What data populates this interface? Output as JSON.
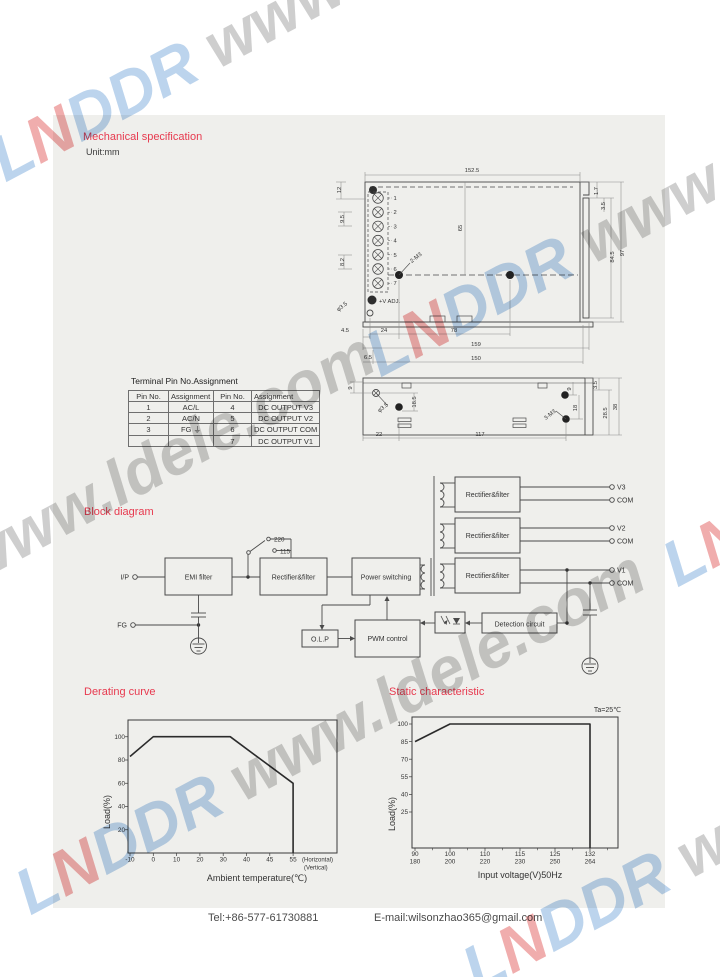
{
  "page": {
    "headings": {
      "mechanical": "Mechanical specification",
      "unit": "Unit:mm",
      "block_diagram": "Block diagram"
    },
    "footer": {
      "tel": "Tel:+86-577-61730881",
      "email": "E-mail:wilsonzhao365@gmail.com"
    }
  },
  "watermark": {
    "segments": [
      {
        "text": "L",
        "color": "#b9d2ec"
      },
      {
        "text": "N",
        "color": "#f0a9a9"
      },
      {
        "text": "DDR",
        "color": "#b9d2ec"
      },
      {
        "text": " www.ldele.com",
        "color": "#cccccc"
      }
    ]
  },
  "pin_table": {
    "title": "Terminal Pin No.Assignment",
    "headers": [
      "Pin No.",
      "Assignment",
      "Pin No.",
      "Assignment"
    ],
    "rows": [
      [
        "1",
        "AC/L",
        "4",
        "DC OUTPUT  V3"
      ],
      [
        "2",
        "AC/N",
        "5",
        "DC OUTPUT  V2"
      ],
      [
        "3",
        "FG ⏚",
        "6",
        "DC OUTPUT COM"
      ],
      [
        "",
        "",
        "7",
        "DC OUTPUT  V1"
      ]
    ]
  },
  "mech": {
    "pin_numbers": [
      "1",
      "2",
      "3",
      "4",
      "5",
      "6",
      "7"
    ],
    "dim_labels": [
      {
        "t": "152.5",
        "x": 142,
        "y": 12,
        "r": 0
      },
      {
        "t": "12",
        "x": 11,
        "y": 30,
        "r": -90
      },
      {
        "t": "9.5",
        "x": 14,
        "y": 59,
        "r": -90
      },
      {
        "t": "8.2",
        "x": 14,
        "y": 102,
        "r": -90
      },
      {
        "t": "65",
        "x": 132,
        "y": 68,
        "r": -90
      },
      {
        "t": "2-M3",
        "x": 87,
        "y": 99,
        "r": -38
      },
      {
        "t": "+V ADJ.",
        "x": 49,
        "y": 143,
        "r": 0,
        "a": "start"
      },
      {
        "t": "φ3.5",
        "x": 13,
        "y": 148,
        "r": -38
      },
      {
        "t": "4.5",
        "x": 15,
        "y": 172,
        "r": 0
      },
      {
        "t": "24",
        "x": 54,
        "y": 172,
        "r": 0
      },
      {
        "t": "78",
        "x": 124,
        "y": 172,
        "r": 0
      },
      {
        "t": "159",
        "x": 146,
        "y": 186,
        "r": 0
      },
      {
        "t": "6.5",
        "x": 38,
        "y": 199,
        "r": 0
      },
      {
        "t": "150",
        "x": 146,
        "y": 200,
        "r": 0
      },
      {
        "t": "1.7",
        "x": 268,
        "y": 31,
        "r": -90
      },
      {
        "t": "3.5",
        "x": 275,
        "y": 46,
        "r": -90
      },
      {
        "t": "84.5",
        "x": 284,
        "y": 97,
        "r": -90
      },
      {
        "t": "97",
        "x": 294,
        "y": 93,
        "r": -90
      },
      {
        "t": "9",
        "x": 22,
        "y": 228,
        "r": -90
      },
      {
        "t": "18.5",
        "x": 86,
        "y": 242,
        "r": -90
      },
      {
        "t": "φ3.5",
        "x": 54,
        "y": 249,
        "r": -38
      },
      {
        "t": "3-M3",
        "x": 221,
        "y": 256,
        "r": -38
      },
      {
        "t": "9",
        "x": 241,
        "y": 229,
        "r": -90
      },
      {
        "t": "18",
        "x": 247,
        "y": 248,
        "r": -90
      },
      {
        "t": "3.5",
        "x": 267,
        "y": 225,
        "r": -90
      },
      {
        "t": "28.5",
        "x": 277,
        "y": 253,
        "r": -90
      },
      {
        "t": "38",
        "x": 287,
        "y": 247,
        "r": -90
      },
      {
        "t": "22",
        "x": 49,
        "y": 276,
        "r": 0
      },
      {
        "t": "117",
        "x": 150,
        "y": 276,
        "r": 0
      }
    ]
  },
  "block_diagram": {
    "boxes": {
      "emi": "EMI filter",
      "rect1": "Rectifier&filter",
      "power": "Power switching",
      "rect_v3": "Rectifier&filter",
      "rect_v2": "Rectifier&filter",
      "rect_v1": "Rectifier&filter",
      "pwm": "PWM control",
      "olp": "O.L.P",
      "detect": "Detection circuit"
    },
    "terminals": {
      "ip": "I/P",
      "fg": "FG",
      "v3": "V3",
      "com3": "COM",
      "v2": "V2",
      "com2": "COM",
      "v1": "V1",
      "com1": "COM"
    },
    "switch": {
      "top": "220",
      "bottom": "115"
    }
  },
  "chart_data": [
    {
      "id": "derating-curve",
      "type": "line",
      "title": "Derating curve",
      "xlabel": "Ambient temperature(℃)",
      "ylabel": "Load(%)",
      "x_ticks": [
        "-10",
        "0",
        "10",
        "20",
        "30",
        "40",
        "45",
        "55"
      ],
      "x_tick_values": [
        -10,
        0,
        10,
        20,
        30,
        40,
        45,
        55
      ],
      "x_axis_notes": [
        "(Horizontal)",
        "(Vertical)"
      ],
      "y_ticks": [
        20,
        40,
        60,
        80,
        100
      ],
      "ylim": [
        0,
        113
      ],
      "points": [
        [
          -10,
          83
        ],
        [
          0,
          100
        ],
        [
          33,
          100
        ],
        [
          55,
          60
        ],
        [
          55,
          0
        ]
      ]
    },
    {
      "id": "static-characteristic",
      "type": "line",
      "title": "Static characteristic",
      "annotation": "Ta=25℃",
      "xlabel": "Input voltage(V)50Hz",
      "ylabel": "Load(%)",
      "x_ticks_top": [
        "90",
        "100",
        "110",
        "115",
        "125",
        "132"
      ],
      "x_ticks_bottom": [
        "180",
        "200",
        "220",
        "230",
        "250",
        "264"
      ],
      "x_tick_values": [
        90,
        100,
        110,
        115,
        125,
        132
      ],
      "y_ticks": [
        25,
        40,
        55,
        70,
        85,
        100
      ],
      "ylim": [
        0,
        110
      ],
      "points": [
        [
          90,
          85
        ],
        [
          100,
          100
        ],
        [
          132,
          100
        ],
        [
          132,
          0
        ]
      ]
    }
  ]
}
